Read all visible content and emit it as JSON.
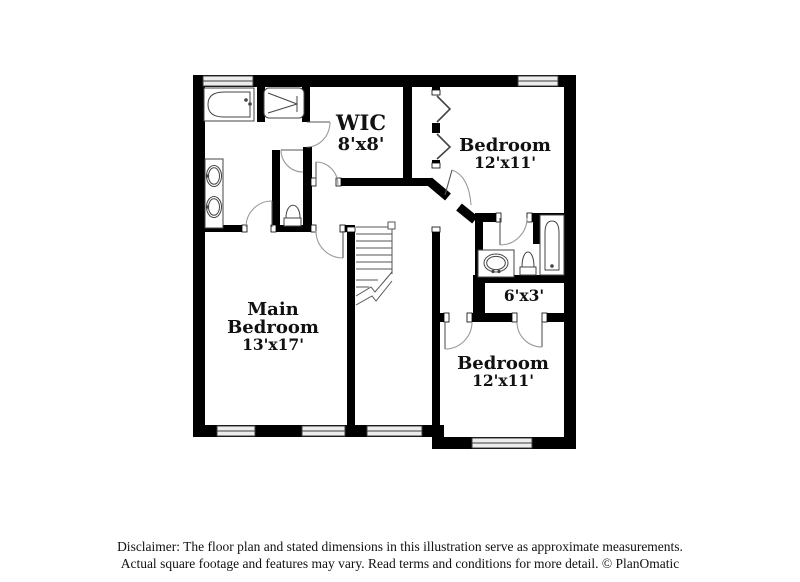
{
  "plan": {
    "type": "second-floor residential floor plan",
    "rooms": {
      "wic": {
        "name": "WIC",
        "dims": "8'x8'"
      },
      "bedroom_top_right": {
        "name": "Bedroom",
        "dims": "12'x11'"
      },
      "main_bedroom": {
        "name_line1": "Main",
        "name_line2": "Bedroom",
        "dims": "13'x17'"
      },
      "bedroom_bottom_right": {
        "name": "Bedroom",
        "dims": "12'x11'"
      },
      "closet": {
        "dims": "6'x3'"
      }
    },
    "fixtures": [
      "bathtub-icon",
      "shower-icon",
      "double-vanity-sinks-icon",
      "toilet-icon",
      "stairs-icon",
      "bathtub-icon",
      "vanity-sink-icon",
      "toilet-icon",
      "bifold-closet-doors-icon"
    ],
    "colors": {
      "wall": "#000000",
      "background": "#ffffff",
      "window_fill": "#ededed",
      "fixture_line": "#444444",
      "door_arc": "#9a9a9a",
      "stair_line": "#555555"
    }
  },
  "disclaimer": {
    "line1": "Disclaimer: The floor plan and stated dimensions in this illustration serve as approximate measurements.",
    "line2": "Actual square footage and features may vary. Read terms and conditions for more detail. © PlanOmatic"
  }
}
